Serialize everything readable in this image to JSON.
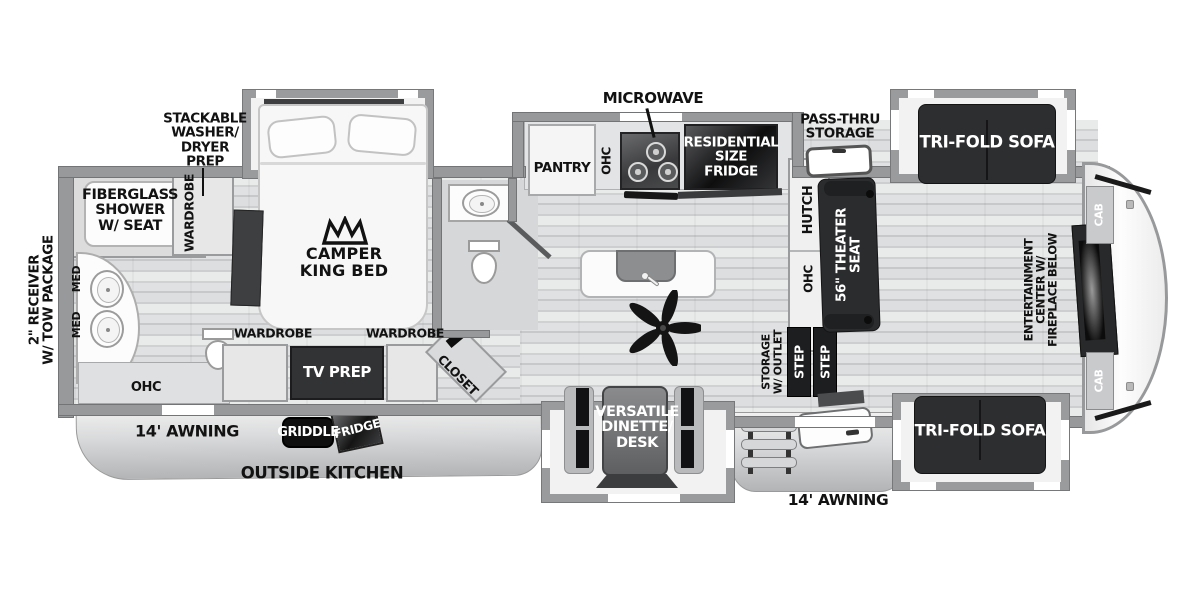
{
  "labels": {
    "tow": "2\" RECEIVER\nW/ TOW PACKAGE",
    "washer_prep": "STACKABLE\nWASHER/\nDRYER\nPREP",
    "shower": "FIBERGLASS\nSHOWER\nW/ SEAT",
    "wardrobe": "WARDROBE",
    "med": "MED",
    "king_bed": "CAMPER\nKING BED",
    "microwave": "MICROWAVE",
    "pantry": "PANTRY",
    "ohc": "OHC",
    "fridge_res": "RESIDENTIAL\nSIZE\nFRIDGE",
    "pass_thru": "PASS-THRU\nSTORAGE",
    "trifold": "TRI-FOLD SOFA",
    "hutch": "HUTCH",
    "theater": "56\" THEATER\nSEAT",
    "ent_center": "ENTERTAINMENT\nCENTER W/\nFIREPLACE BELOW",
    "cab": "CAB",
    "tv_prep": "TV PREP",
    "closet": "CLOSET",
    "awning": "14' AWNING",
    "griddle": "GRIDDLE",
    "fridge_out": "FRIDGE",
    "outside_kitchen": "OUTSIDE KITCHEN",
    "dinette": "VERSATILE\nDINETTE/\nDESK",
    "storage_outlet": "STORAGE\nW/ OUTLET",
    "step": "STEP"
  },
  "colors": {
    "wall": "#98999b",
    "dark_furniture": "#2d2e30",
    "floor_light": "#e3e4e5",
    "label_black": "#121212",
    "label_white": "#ffffff"
  }
}
